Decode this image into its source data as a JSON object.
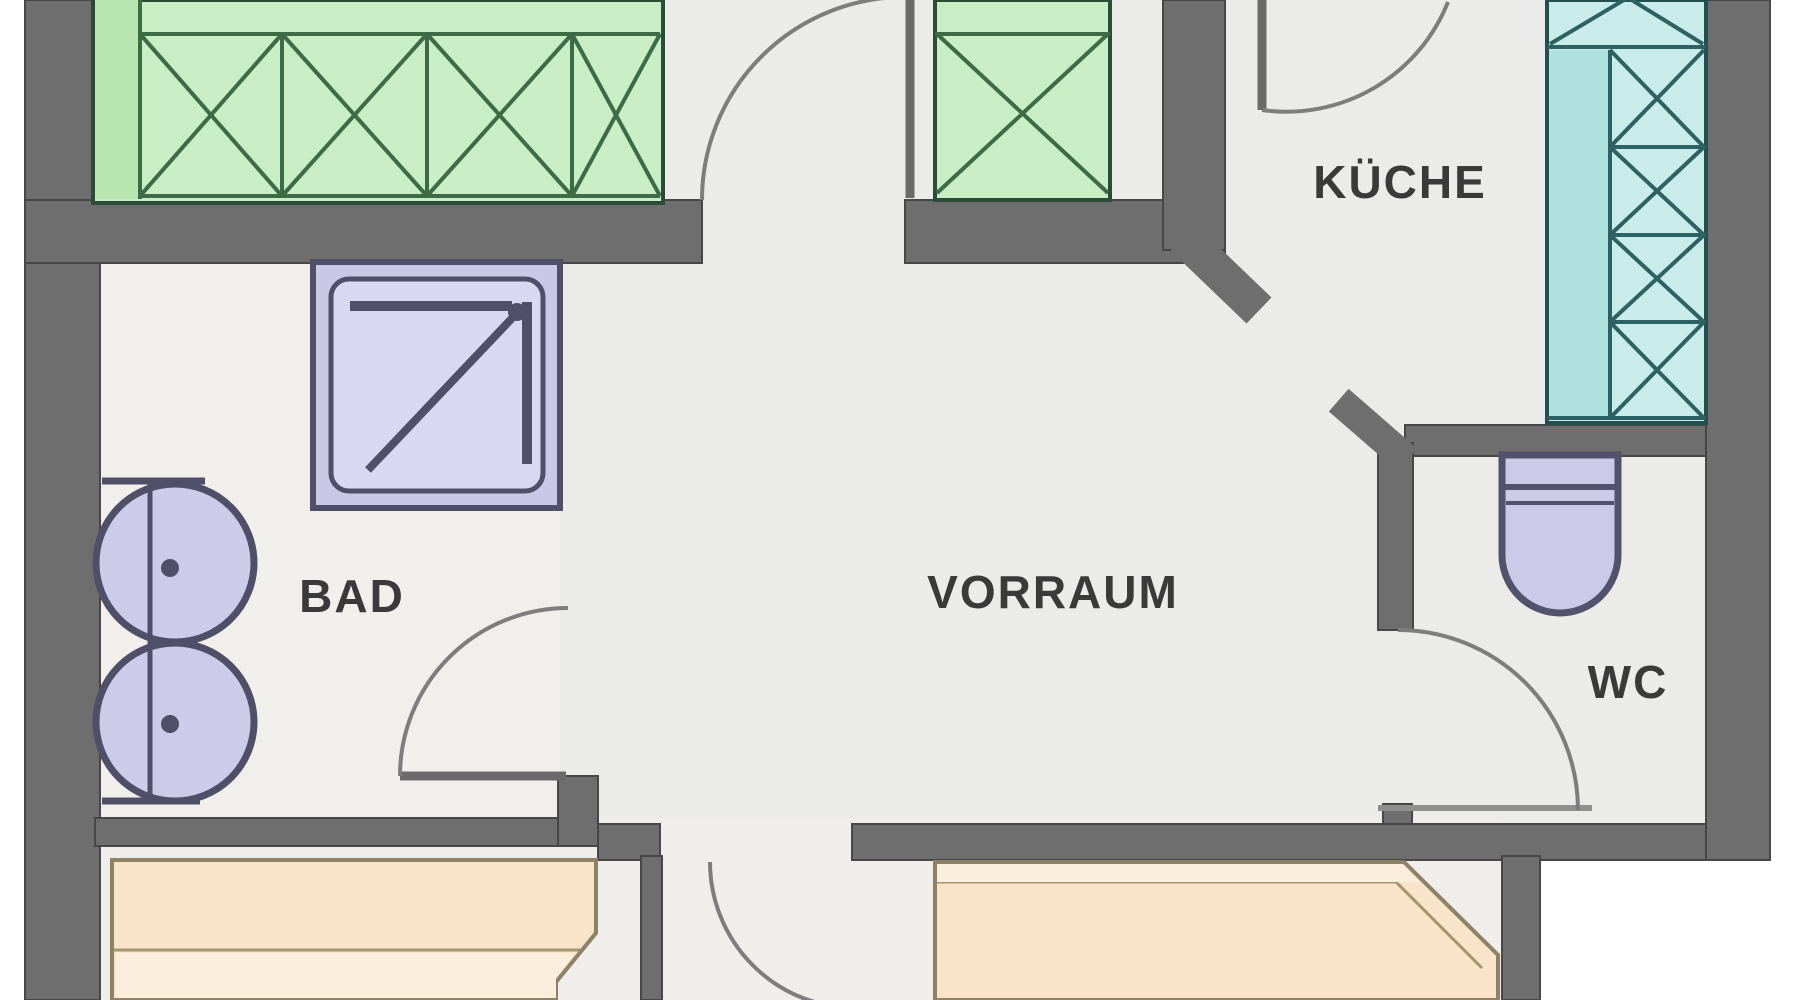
{
  "plan": {
    "rooms": {
      "kueche": {
        "label": "KÜCHE"
      },
      "vorraum": {
        "label": "VORRAUM"
      },
      "bad": {
        "label": "BAD"
      },
      "wc": {
        "label": "WC"
      }
    },
    "fixtures": [
      {
        "name": "wardrobe-row",
        "color": "#c9edc5"
      },
      {
        "name": "wardrobe-single",
        "color": "#c9edc5"
      },
      {
        "name": "kitchen-counter",
        "color": "#c9eceb"
      },
      {
        "name": "shower",
        "color": "#d9d8f2"
      },
      {
        "name": "double-washbasin",
        "color": "#cccbe9"
      },
      {
        "name": "toilet",
        "color": "#cbcae8"
      },
      {
        "name": "bed-left",
        "color": "#f9e4c9"
      },
      {
        "name": "bed-right",
        "color": "#f9e4c9"
      }
    ],
    "colors": {
      "wall": "#6e6e6e",
      "floor": "#ebebe9",
      "outside": "#ffffff",
      "door_arc": "#7d7d7d",
      "label_text": "#3a3a3a",
      "green_line": "#3c6b46",
      "teal_line": "#2e6162",
      "purple_line": "#504f6a",
      "bed_line": "#8e8165"
    }
  }
}
